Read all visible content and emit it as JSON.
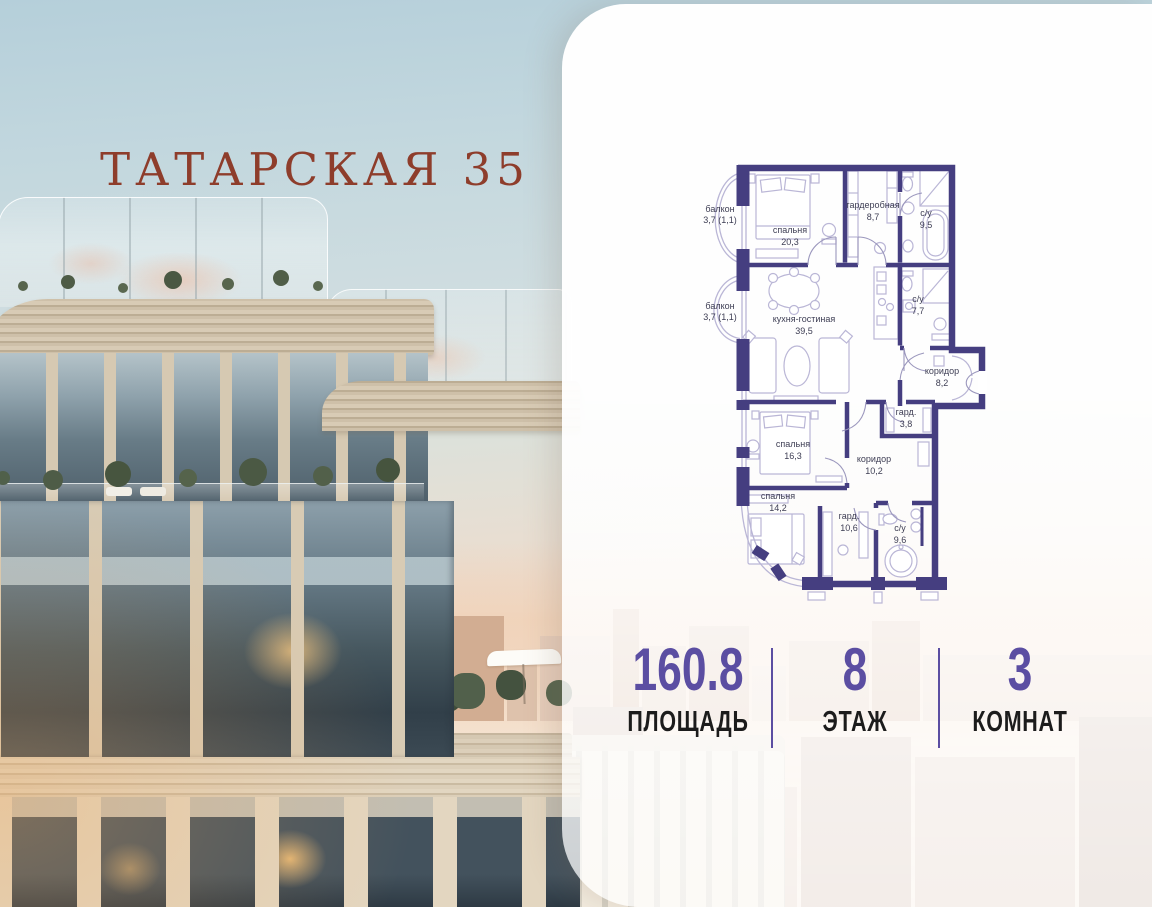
{
  "title": "ТАТАРСКАЯ 35",
  "plan": {
    "rooms": [
      {
        "name": "балкон",
        "area": "3,7 (1,1)"
      },
      {
        "name": "спальня",
        "area": "20,3"
      },
      {
        "name": "гардеробная",
        "area": "8,7"
      },
      {
        "name": "с/у",
        "area": "9,5"
      },
      {
        "name": "балкон",
        "area": "3,7 (1,1)"
      },
      {
        "name": "кухня-гостиная",
        "area": "39,5"
      },
      {
        "name": "с/у",
        "area": "7,7"
      },
      {
        "name": "коридор",
        "area": "8,2"
      },
      {
        "name": "гард.",
        "area": "3,8"
      },
      {
        "name": "спальня",
        "area": "16,3"
      },
      {
        "name": "коридор",
        "area": "10,2"
      },
      {
        "name": "спальня",
        "area": "14,2"
      },
      {
        "name": "гард.",
        "area": "10,6"
      },
      {
        "name": "с/у",
        "area": "9,6"
      }
    ]
  },
  "stats": [
    {
      "value": "160.8",
      "label": "ПЛОЩАДЬ"
    },
    {
      "value": "8",
      "label": "ЭТАЖ"
    },
    {
      "value": "3",
      "label": "КОМНАТ"
    }
  ],
  "colors": {
    "accent_purple": "#5B4EA2",
    "plan_wall": "#453E80",
    "plan_fixture": "#BAB6D6",
    "plan_label": "#3E3E54",
    "title_red": "#8E3D2B",
    "stat_label": "#1C1C1C"
  }
}
